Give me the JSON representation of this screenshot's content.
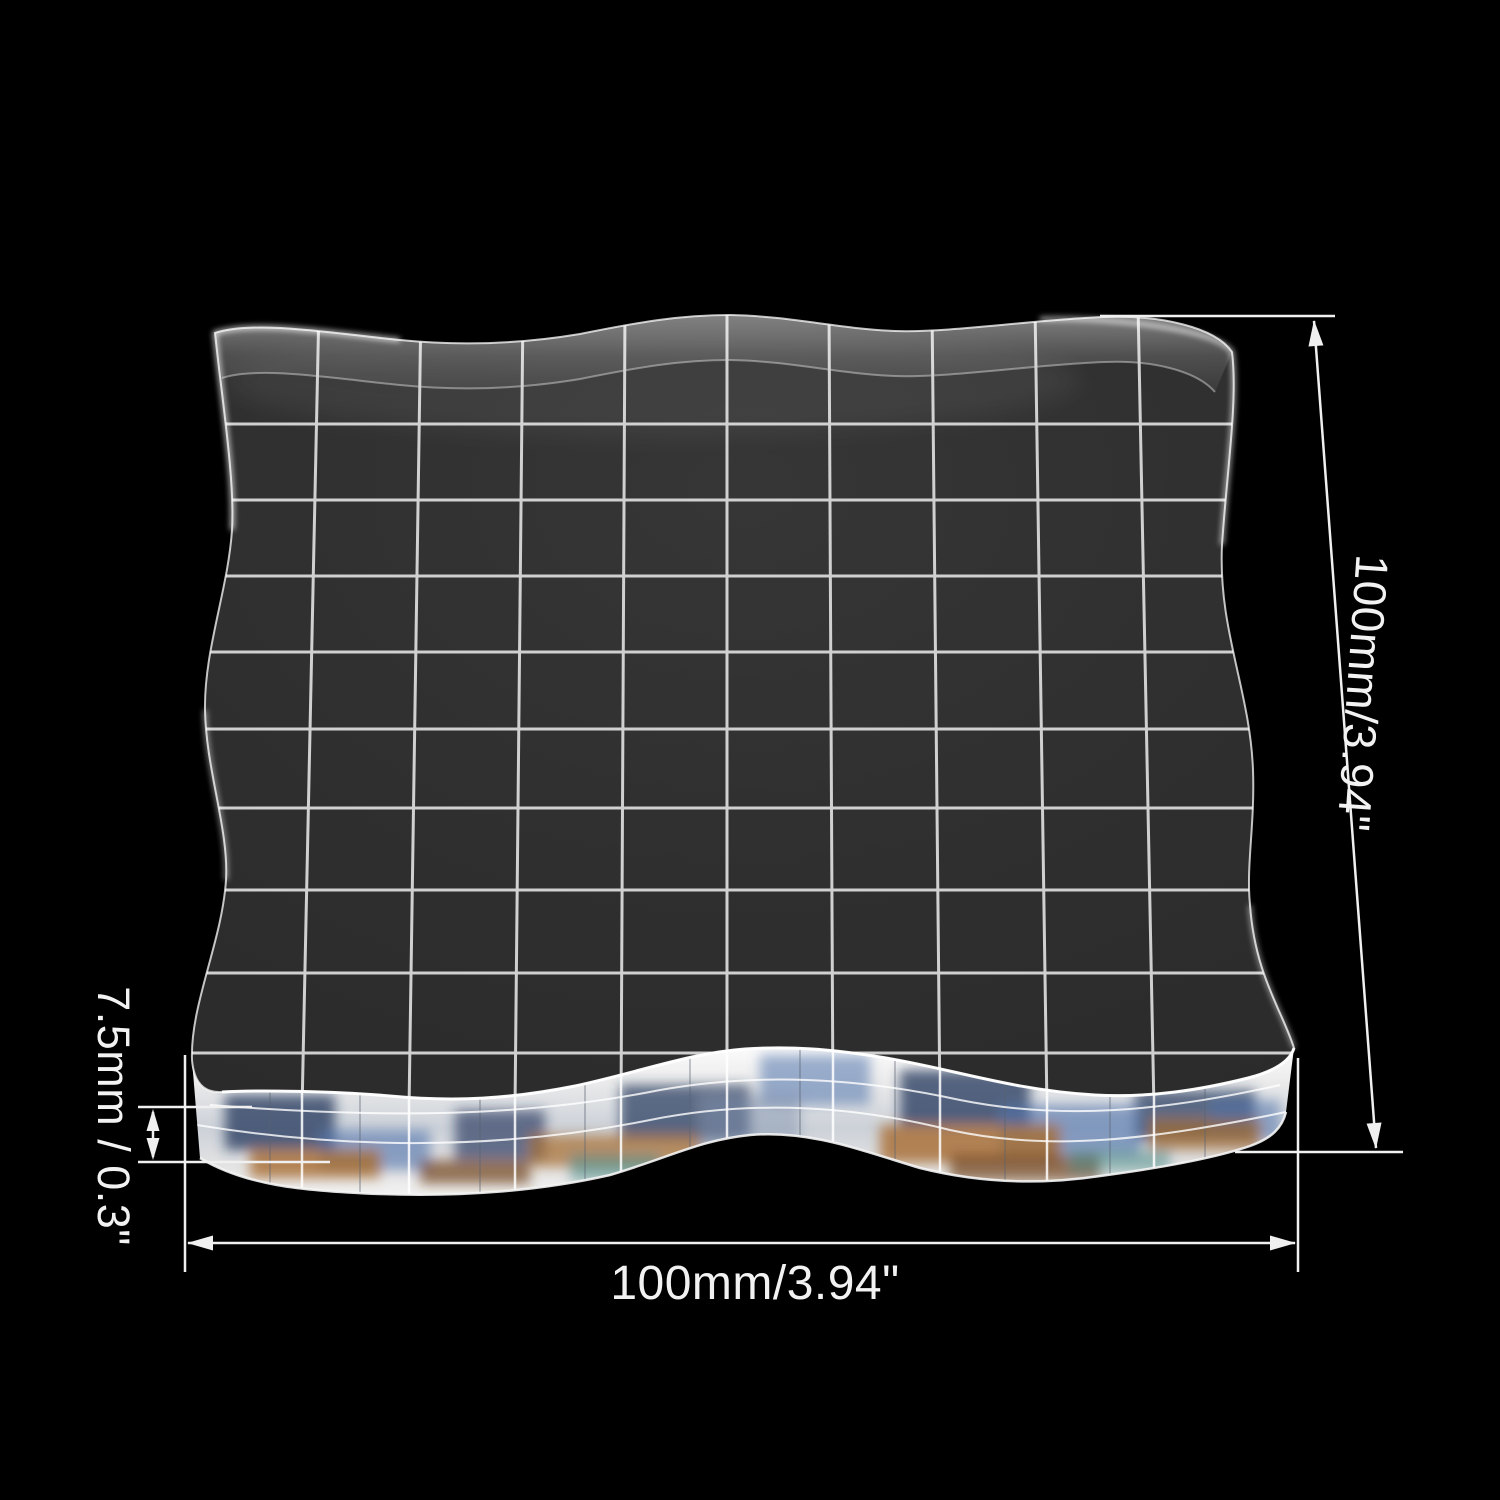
{
  "scene": {
    "description": "Transparent acrylic stamp block with etched square grid, product photo on a black background with white dimension callouts",
    "background_color": "#000000"
  },
  "block": {
    "type": "clear acrylic stamping block",
    "grid": {
      "columns": 10,
      "rows": 10,
      "line_color": "#e0e0e0"
    },
    "face_color": "#2f2f2f",
    "edge_highlight_color": "#ffffff",
    "side_face_tints": [
      "#24365c",
      "#4f73ab",
      "#a76c2e",
      "#70421f",
      "#4d8d88",
      "#8394ad"
    ]
  },
  "dimensions": {
    "line_color": "#f0f0f0",
    "height": {
      "label": "100mm/3.94\""
    },
    "width": {
      "label": "100mm/3.94\""
    },
    "thickness": {
      "label": "7.5mm / 0.3\""
    }
  }
}
